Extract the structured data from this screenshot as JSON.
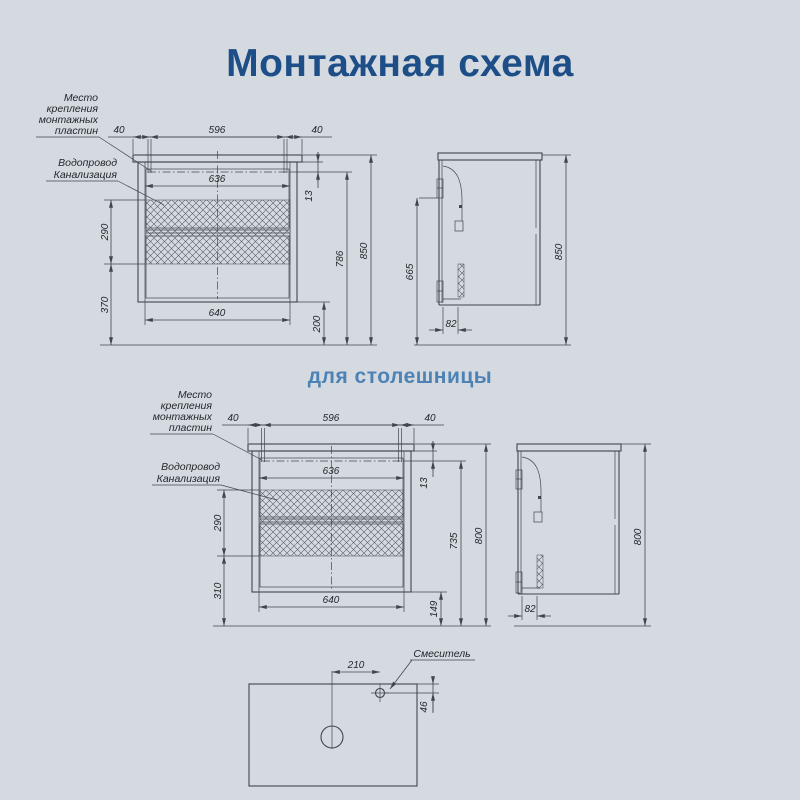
{
  "page": {
    "title": "Монтажная схема",
    "subtitle": "для столешницы",
    "background": "#d5dae1",
    "title_color": "#1d4e87",
    "subtitle_color": "#4d82b5",
    "line_color": "#41464d"
  },
  "labels": {
    "mounting_plates": {
      "line1": "Место",
      "line2": "крепления",
      "line3": "монтажных",
      "line4": "пластин"
    },
    "plumbing": {
      "line1": "Водопровод",
      "line2": "Канализация"
    },
    "mixer": "Смеситель"
  },
  "wall_mounted_unit": {
    "front": {
      "plate_offset_left": "40",
      "plate_spacing": "596",
      "plate_offset_right": "40",
      "inner_width_top": "636",
      "plate_drop": "13",
      "service_zone_height": "290",
      "service_zone_floor_offset": "370",
      "inner_width_bottom": "640",
      "cabinet_floor_gap": "200",
      "plate_line_height": "786",
      "total_height": "850"
    },
    "side": {
      "plate_to_floor": "665",
      "plate_depth": "82",
      "total_height": "850"
    }
  },
  "countertop_unit": {
    "front": {
      "plate_offset_left": "40",
      "plate_spacing": "596",
      "plate_offset_right": "40",
      "inner_width_top": "636",
      "plate_drop": "13",
      "service_zone_height": "290",
      "service_zone_floor_offset": "310",
      "inner_width_bottom": "640",
      "cabinet_floor_gap": "149",
      "plate_line_height": "735",
      "total_height": "800"
    },
    "side": {
      "plate_depth": "82",
      "total_height": "800"
    }
  },
  "countertop_plan": {
    "mixer_offset_from_center": "210",
    "mixer_offset_from_edge": "46"
  }
}
